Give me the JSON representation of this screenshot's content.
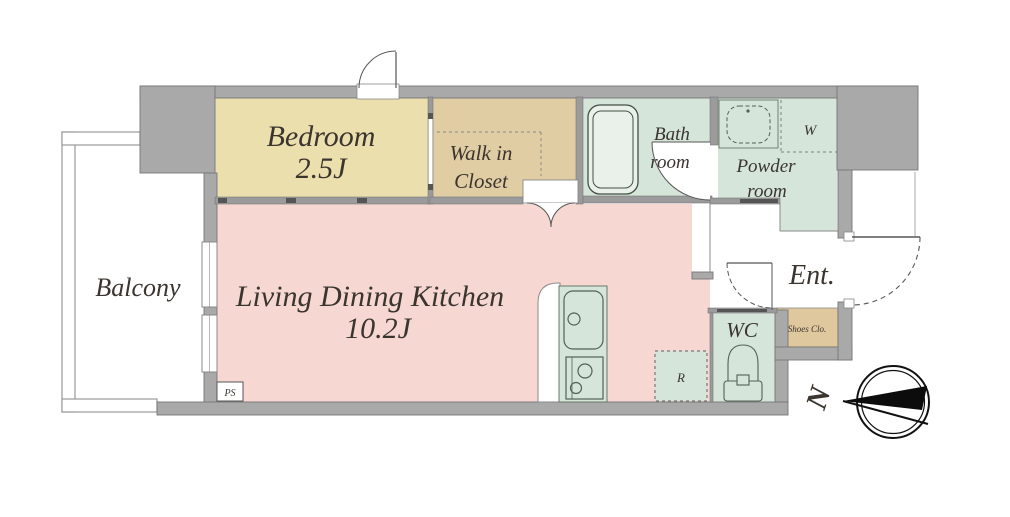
{
  "floor_plan": {
    "rooms": {
      "bedroom": {
        "name": "Bedroom",
        "size": "2.5J"
      },
      "walk_in_closet": {
        "name_line1": "Walk in",
        "name_line2": "Closet"
      },
      "bath_room": {
        "name_line1": "Bath",
        "name_line2": "room"
      },
      "powder_room": {
        "name_line1": "Powder",
        "name_line2": "room"
      },
      "living_dining_kitchen": {
        "name": "Living Dining Kitchen",
        "size": "10.2J"
      },
      "balcony": {
        "name": "Balcony"
      },
      "wc": {
        "name": "WC"
      },
      "entrance": {
        "name": "Ent."
      },
      "shoes_closet": {
        "name": "Shoes Clo."
      }
    },
    "markers": {
      "washer": "W",
      "refrigerator": "R",
      "pipe_shaft": "PS",
      "compass_north": "N"
    },
    "colors": {
      "wall": "#a9a9a9",
      "bedroom": "#ecdfae",
      "closet": "#e0cda3",
      "shoes_closet": "#dfc79e",
      "wet_area_green": "#d5e5da",
      "ldk_pink": "#f6d7d1",
      "tub_fill": "#e9f1ea",
      "line_dark": "#555555",
      "compass_black": "#0c0c0c"
    }
  }
}
